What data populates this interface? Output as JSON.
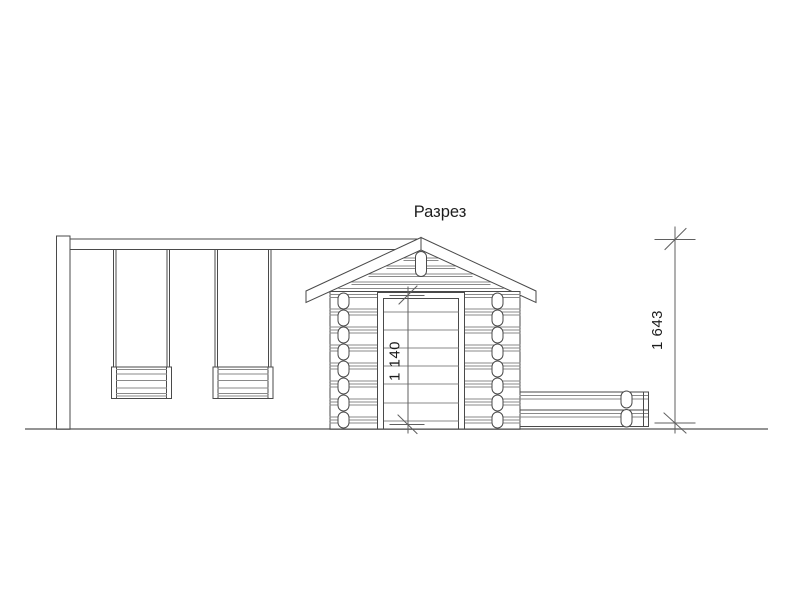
{
  "page": {
    "background": "#ffffff"
  },
  "drawing": {
    "title": "Разрез",
    "dimensions": {
      "door_height": "1 140",
      "frame_height": "1 643"
    },
    "colors": {
      "primary_line": "#4a4a4a",
      "secondary_line": "#8a8a8a",
      "dimension_line": "#5f5f5f",
      "ground_line": "#949494",
      "text": "#1d1d1d",
      "background": "#ffffff"
    }
  }
}
